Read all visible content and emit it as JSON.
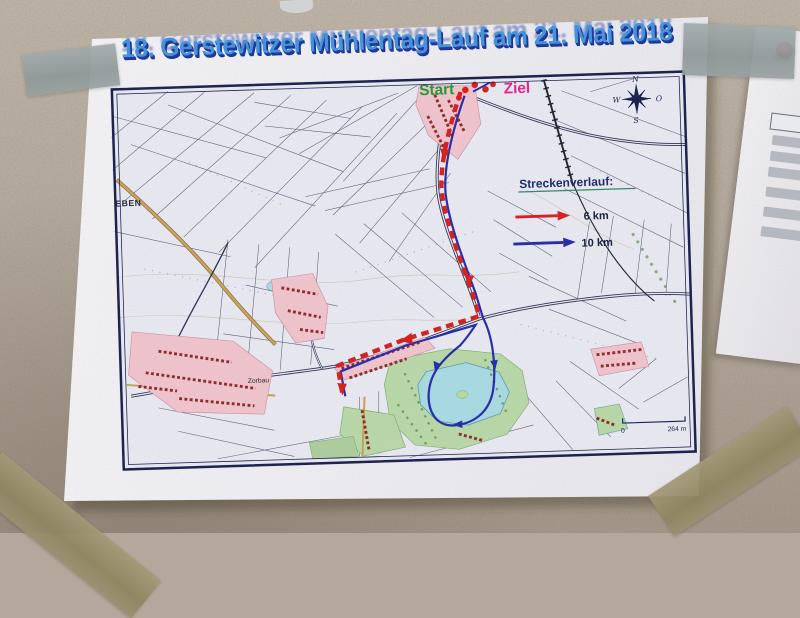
{
  "poster": {
    "title": "18. Gerstewitzer Mühlentag-Lauf am 21. Mai 2018",
    "start_label": "Start",
    "ziel_label": "Ziel",
    "legend": {
      "heading": "Streckenverlauf:",
      "items": [
        {
          "label": "6 km",
          "color": "#d81f1f"
        },
        {
          "label": "10 km",
          "color": "#252cab"
        }
      ]
    },
    "map_labels": {
      "eben": "EBEN",
      "zorbau": "Zorbau"
    },
    "compass": {
      "n": "N",
      "o": "O",
      "s": "S",
      "w": "W"
    },
    "scale": {
      "zero": "0",
      "max": "264 m"
    }
  },
  "appearance": {
    "title_color": "#4493dc",
    "title_shadow_color": "#16309a",
    "start_color": "#1e9b33",
    "ziel_color": "#e6218e",
    "route_6km_color": "#d81f1f",
    "route_10km_color": "#252cab",
    "map_border_color": "#1a1f4e",
    "village_fill": "#f1c5ce",
    "water_fill": "#a9dbe4",
    "wall_color": "#b3a89b",
    "tape_gray": "#97a1a3",
    "tape_olive": "#998e6d"
  }
}
